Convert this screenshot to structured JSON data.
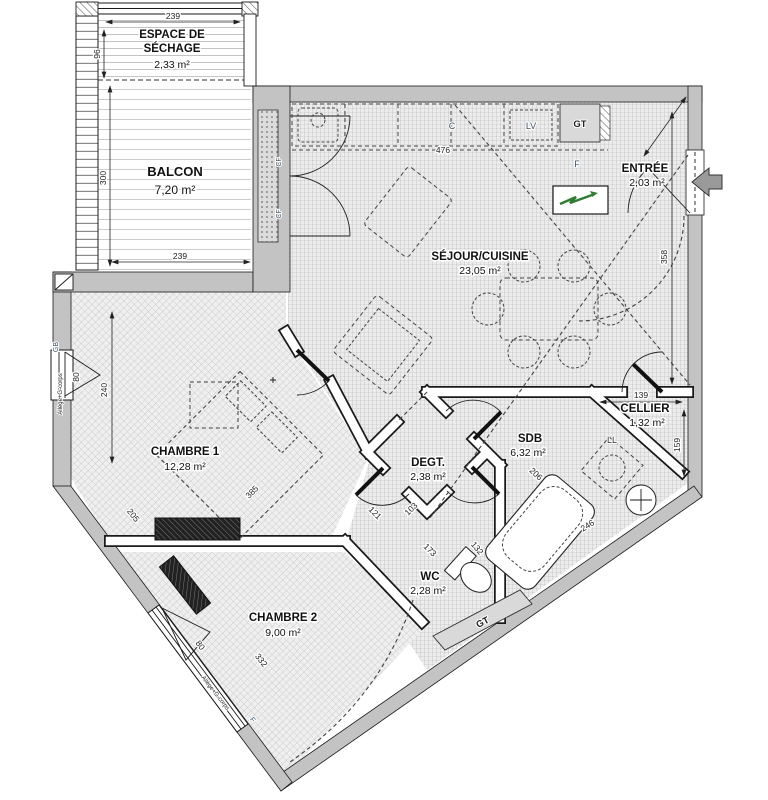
{
  "rooms": [
    {
      "name": "ESPACE DE",
      "name2": "SÉCHAGE",
      "area": "2,33 m²"
    },
    {
      "name": "BALCON",
      "area": "7,20 m²"
    },
    {
      "name": "SÉJOUR/CUISINE",
      "area": "23,05 m²"
    },
    {
      "name": "ENTRÉE",
      "area": "2,03 m²"
    },
    {
      "name": "CELLIER",
      "area": "1,32 m²"
    },
    {
      "name": "SDB",
      "area": "6,32 m²"
    },
    {
      "name": "DEGT.",
      "area": "2,38 m²"
    },
    {
      "name": "WC",
      "area": "2,28 m²"
    },
    {
      "name": "CHAMBRE 1",
      "area": "12,28 m²"
    },
    {
      "name": "CHAMBRE 2",
      "area": "9,00 m²"
    }
  ],
  "labels": {
    "gt_top": "GT",
    "gt_low": "GT",
    "lv": "LV",
    "c": "C",
    "f_entree": "F",
    "f_ch2": "F",
    "ll": "LL",
    "gb": "GB",
    "cf_a": "CF",
    "cf_b": "CF",
    "allege_ch1": "Allège+G-corps",
    "allege_ch2": "Allège+G-corps"
  },
  "dims": {
    "sechage_w": "239",
    "sechage_h": "96",
    "balcon_h": "300",
    "balcon_w": "239",
    "kitchen_w": "476",
    "sejour_h": "358",
    "ch1_h": "240",
    "ch1_win": "80",
    "ch1_diag": "205",
    "bed": "385",
    "cellier_w": "139",
    "cellier_h": "159",
    "sdb_diag": "206",
    "sdb_low": "246",
    "degt_a": "121",
    "degt_b": "103",
    "wc_diag": "173",
    "wc_b": "132",
    "ch2_diag": "332",
    "ch2_win": "80"
  }
}
